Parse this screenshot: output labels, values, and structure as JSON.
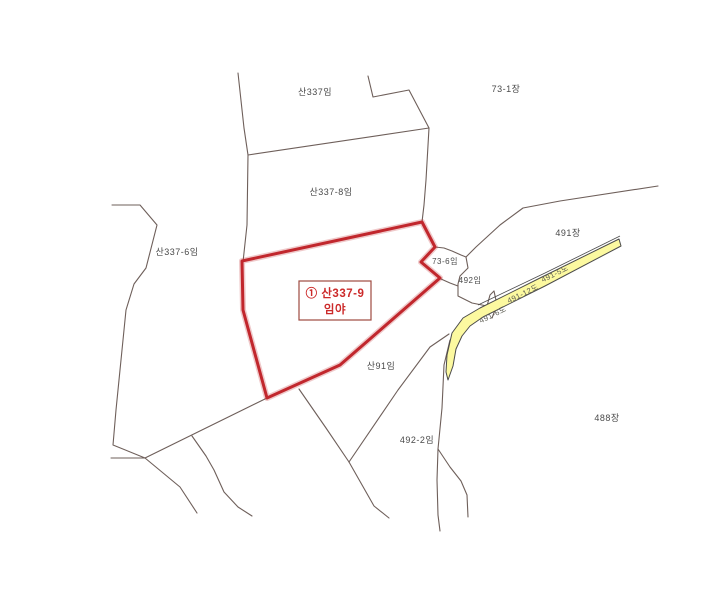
{
  "map": {
    "colors": {
      "highlight": "#c1272d",
      "highlight_text": "#cc2a2a",
      "road_fill": "#fcf9a0",
      "road_border": "#4b4b4b",
      "boundary": "#6e5f5a",
      "label": "#4a4a4a"
    },
    "highlight_box": {
      "line1": "① 산337-9",
      "line2": "임야"
    },
    "parcel_labels": [
      {
        "text": "산337임"
      },
      {
        "text": "73-1장"
      },
      {
        "text": "산337-8임"
      },
      {
        "text": "산337-6임"
      },
      {
        "text": "73-6임"
      },
      {
        "text": "492임"
      },
      {
        "text": "491장"
      },
      {
        "text": "산91임"
      },
      {
        "text": "492-2임"
      },
      {
        "text": "488장"
      }
    ],
    "road_labels": [
      {
        "text": "491-5도"
      },
      {
        "text": "491-12도"
      },
      {
        "text": "491-6도"
      }
    ]
  }
}
